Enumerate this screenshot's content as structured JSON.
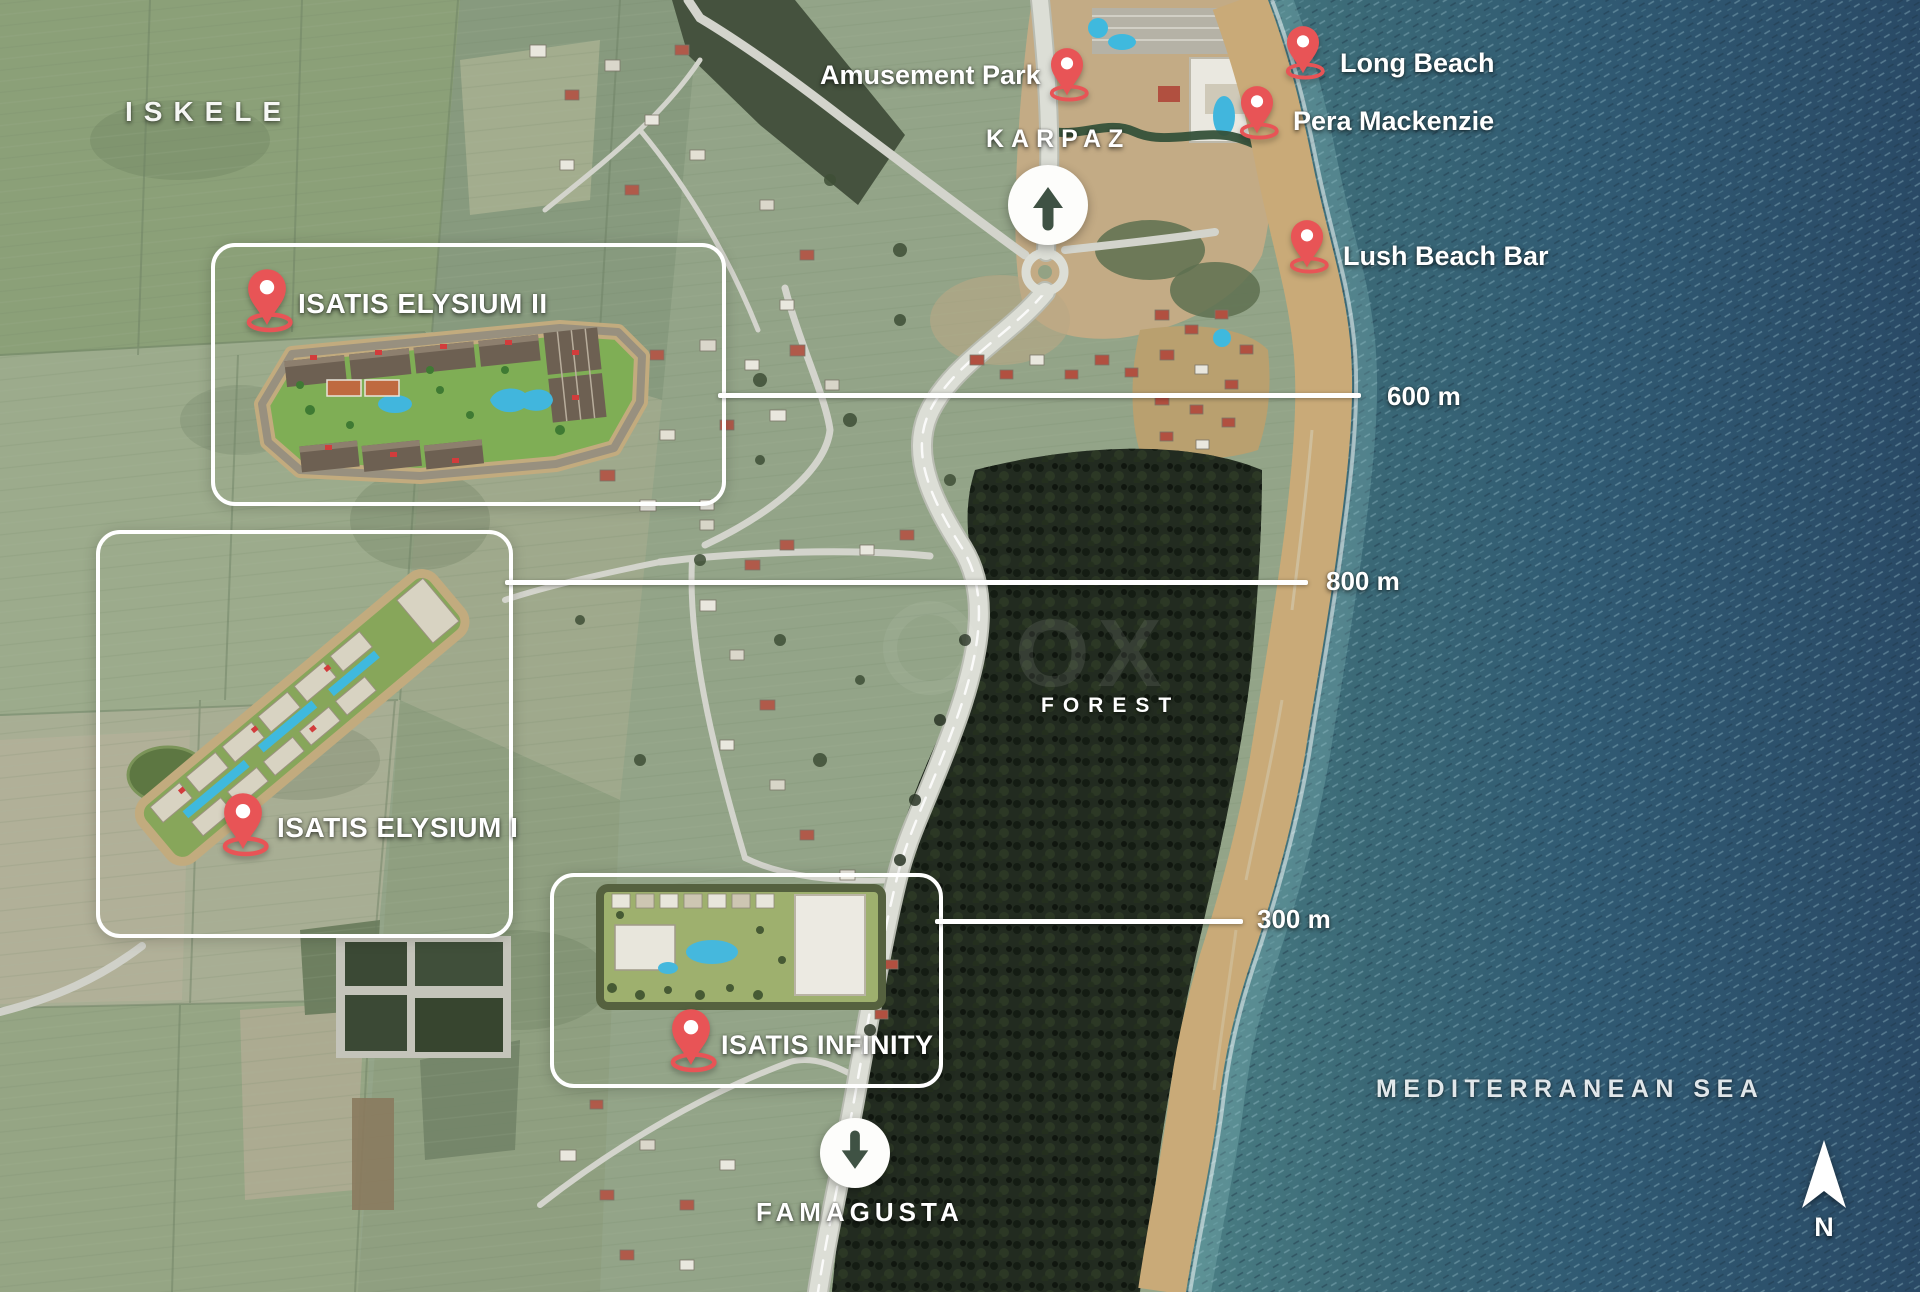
{
  "region_labels": {
    "iskele": "ISKELE",
    "forest": "FOREST",
    "sea": "MEDITERRANEAN SEA"
  },
  "watermark": "OX",
  "directions": {
    "north": "KARPAZ",
    "south": "FAMAGUSTA",
    "compass_n": "N"
  },
  "pois": [
    {
      "label": "Amusement Park"
    },
    {
      "label": "Long Beach"
    },
    {
      "label": "Pera Mackenzie"
    },
    {
      "label": "Lush Beach Bar"
    }
  ],
  "projects": [
    {
      "label": "ISATIS ELYSIUM II",
      "distance": "600 m"
    },
    {
      "label": "ISATIS ELYSIUM I",
      "distance": "800 m"
    },
    {
      "label": "ISATIS INFINITY",
      "distance": "300 m"
    }
  ],
  "colors": {
    "pin_red": "#e85456",
    "arrow_green": "#3f5244",
    "sea_deep": "#2a4a66",
    "sea_shore": "#4b7f84",
    "beach": "#c9aa78",
    "forest": "#222b20",
    "fields": "#93a488",
    "road": "#d8dad2",
    "label_white": "#ffffff"
  }
}
